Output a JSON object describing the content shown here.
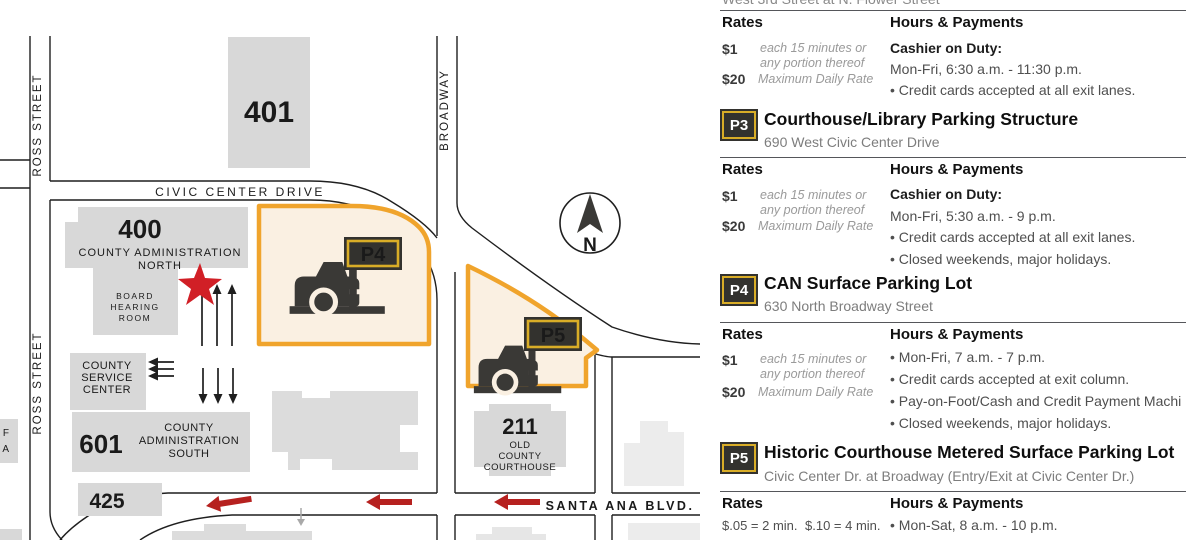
{
  "map": {
    "street_labels": {
      "ross_street_top": "ROSS STREET",
      "ross_street_bottom": "ROSS STREET",
      "civic_center_drive": "CIVIC CENTER DRIVE",
      "broadway": "BROADWAY",
      "santa_ana_blvd": "SANTA ANA BLVD."
    },
    "buildings": {
      "b401": {
        "number": "401"
      },
      "b400": {
        "number": "400",
        "name_line1": "COUNTY ADMINISTRATION",
        "name_line2": "NORTH"
      },
      "board_hearing_room": {
        "line1": "BOARD",
        "line2": "HEARING",
        "line3": "ROOM"
      },
      "county_service_center": {
        "line1": "COUNTY",
        "line2": "SERVICE",
        "line3": "CENTER"
      },
      "b601": {
        "number": "601",
        "name_line1": "COUNTY",
        "name_line2": "ADMINISTRATION",
        "name_line3": "SOUTH"
      },
      "b425": {
        "number": "425"
      },
      "b211": {
        "number": "211",
        "name_line1": "OLD",
        "name_line2": "COUNTY",
        "name_line3": "COURTHOUSE"
      },
      "edge_partial": {
        "line1": "F",
        "line2": "A"
      }
    },
    "lots": {
      "p4_label": "P4",
      "p5_label": "P5"
    },
    "compass_label": "N",
    "colors": {
      "lot_fill": "#faf0e2",
      "lot_border": "#f0a42c",
      "badge_bg": "#33322e",
      "badge_border": "#d9ad27",
      "building_gray": "#d8d8d8",
      "building_light": "#ececec",
      "arrow_red": "#b6211f",
      "star_red": "#d11f26"
    }
  },
  "panel": {
    "truncated_top": "West 3rd Street at N. Flower Street",
    "rates_heading": "Rates",
    "hours_heading": "Hours & Payments",
    "sections": [
      {
        "rates": {
          "r1_amount": "$1",
          "r1_desc1": "each 15 minutes or",
          "r1_desc2": "any portion thereof",
          "r2_amount": "$20",
          "r2_desc": "Maximum Daily Rate"
        },
        "cashier": "Cashier on Duty:",
        "schedule": "Mon-Fri, 6:30 a.m. - 11:30 p.m.",
        "bullets": [
          "• Credit cards accepted at all exit lanes."
        ]
      },
      {
        "badge": "P3",
        "title": "Courthouse/Library Parking Structure",
        "address": "690 West Civic Center Drive",
        "rates": {
          "r1_amount": "$1",
          "r1_desc1": "each 15 minutes or",
          "r1_desc2": "any portion thereof",
          "r2_amount": "$20",
          "r2_desc": "Maximum Daily Rate"
        },
        "cashier": "Cashier on Duty:",
        "schedule": "Mon-Fri, 5:30 a.m. - 9 p.m.",
        "bullets": [
          "• Credit cards accepted at all exit lanes.",
          "• Closed weekends, major holidays."
        ]
      },
      {
        "badge": "P4",
        "title": "CAN Surface Parking Lot",
        "address": "630 North Broadway Street",
        "rates": {
          "r1_amount": "$1",
          "r1_desc1": "each 15 minutes or",
          "r1_desc2": "any portion thereof",
          "r2_amount": "$20",
          "r2_desc": "Maximum Daily Rate"
        },
        "bullets": [
          "• Mon-Fri, 7 a.m. - 7 p.m.",
          "• Credit cards accepted at exit column.",
          "• Pay-on-Foot/Cash and Credit Payment Machi",
          "• Closed weekends, major holidays."
        ]
      },
      {
        "badge": "P5",
        "title": "Historic Courthouse Metered Surface Parking Lot",
        "address": "Civic Center Dr. at Broadway (Entry/Exit at Civic Center Dr.)",
        "rates_meter1": "$.05 = 2 min.",
        "rates_meter2": "$.10 = 4 min.",
        "bullets": [
          "• Mon-Sat, 8 a.m. - 10 p.m."
        ]
      }
    ]
  }
}
